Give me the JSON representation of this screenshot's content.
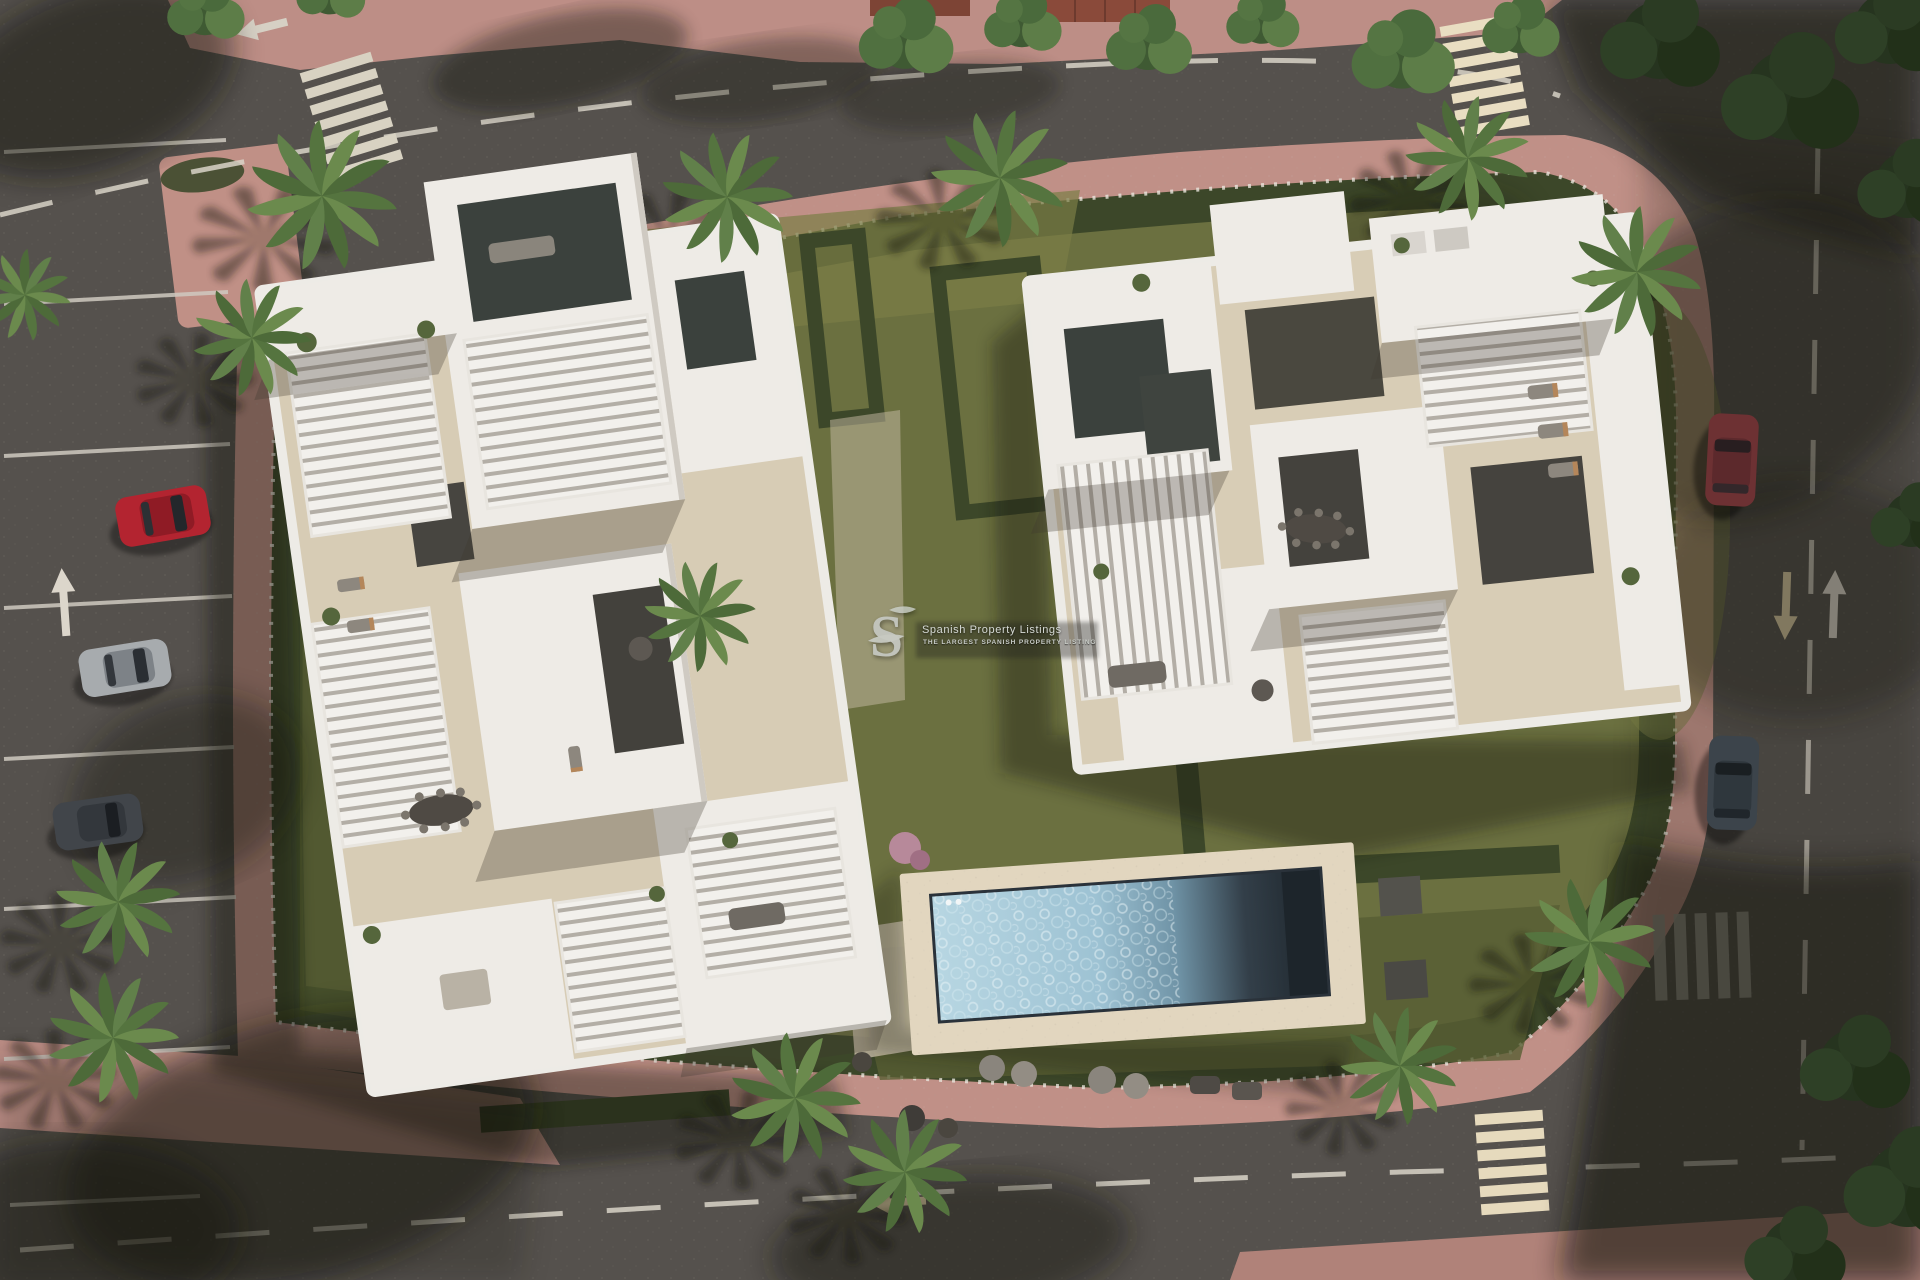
{
  "meta": {
    "kind": "aerial-architectural-render",
    "description": "Top-down 3D visualisation of a residential development: two white modern apartment blocks with roof terraces and louvred pergolas, communal lawned garden with hedge border, long rectangular swimming pool with sun loungers, surrounded by asphalt roads, pink paved sidewalks, zebra crossings, parked cars and palm trees.",
    "width_px": 1920,
    "height_px": 1280
  },
  "watermark": {
    "logo_letter": "S",
    "title": "Spanish Property Listings",
    "subtitle": "THE LARGEST SPANISH PROPERTY LISTING"
  },
  "palette": {
    "asphalt": "#55514d",
    "asphalt_shadow": "#2d2a27",
    "sidewalk_pink": "#c09087",
    "sidewalk_pink_shade": "#8e6a64",
    "grass_green": "#6b7040",
    "grass_shade": "#49512c",
    "hedge_green": "#3c4729",
    "palm_green": "#5d7a45",
    "building_white": "#eeebe6",
    "terrace_beige": "#d7ccb5",
    "courtyard_dark": "#3b413d",
    "pool_water_light": "#b7d6e2",
    "pool_water_dark": "#1b2329",
    "pool_deck": "#e2d6bf",
    "road_marking_white": "#d9d3c8",
    "road_marking_cream": "#d9c9a2",
    "wm_light": "#d6dad5",
    "wm_mid": "#c9cdc8"
  },
  "scene": {
    "buildings": [
      {
        "name": "west apartment block",
        "roof": "white slabs, louvred pergolas, beige terraces, glazed courtyards"
      },
      {
        "name": "east apartment block",
        "roof": "white slabs, louvred pergolas, beige terraces, glazed courtyards"
      }
    ],
    "pool": {
      "shape": "long rectangle",
      "features": "sunlit turquoise water left, shaded dark water right, beige deck, sun loungers"
    },
    "cars": [
      {
        "location": "west road parking",
        "color_name": "red"
      },
      {
        "location": "west road parking",
        "color_name": "silver"
      },
      {
        "location": "west road parking",
        "color_name": "dark grey"
      },
      {
        "location": "east road",
        "color_name": "maroon"
      },
      {
        "location": "east road",
        "color_name": "navy grey"
      }
    ],
    "crosswalks": 4,
    "road_arrows": 5,
    "vegetation": {
      "palm_trees": 13,
      "hedge_border": true,
      "lawns": true,
      "street_trees": true
    }
  }
}
